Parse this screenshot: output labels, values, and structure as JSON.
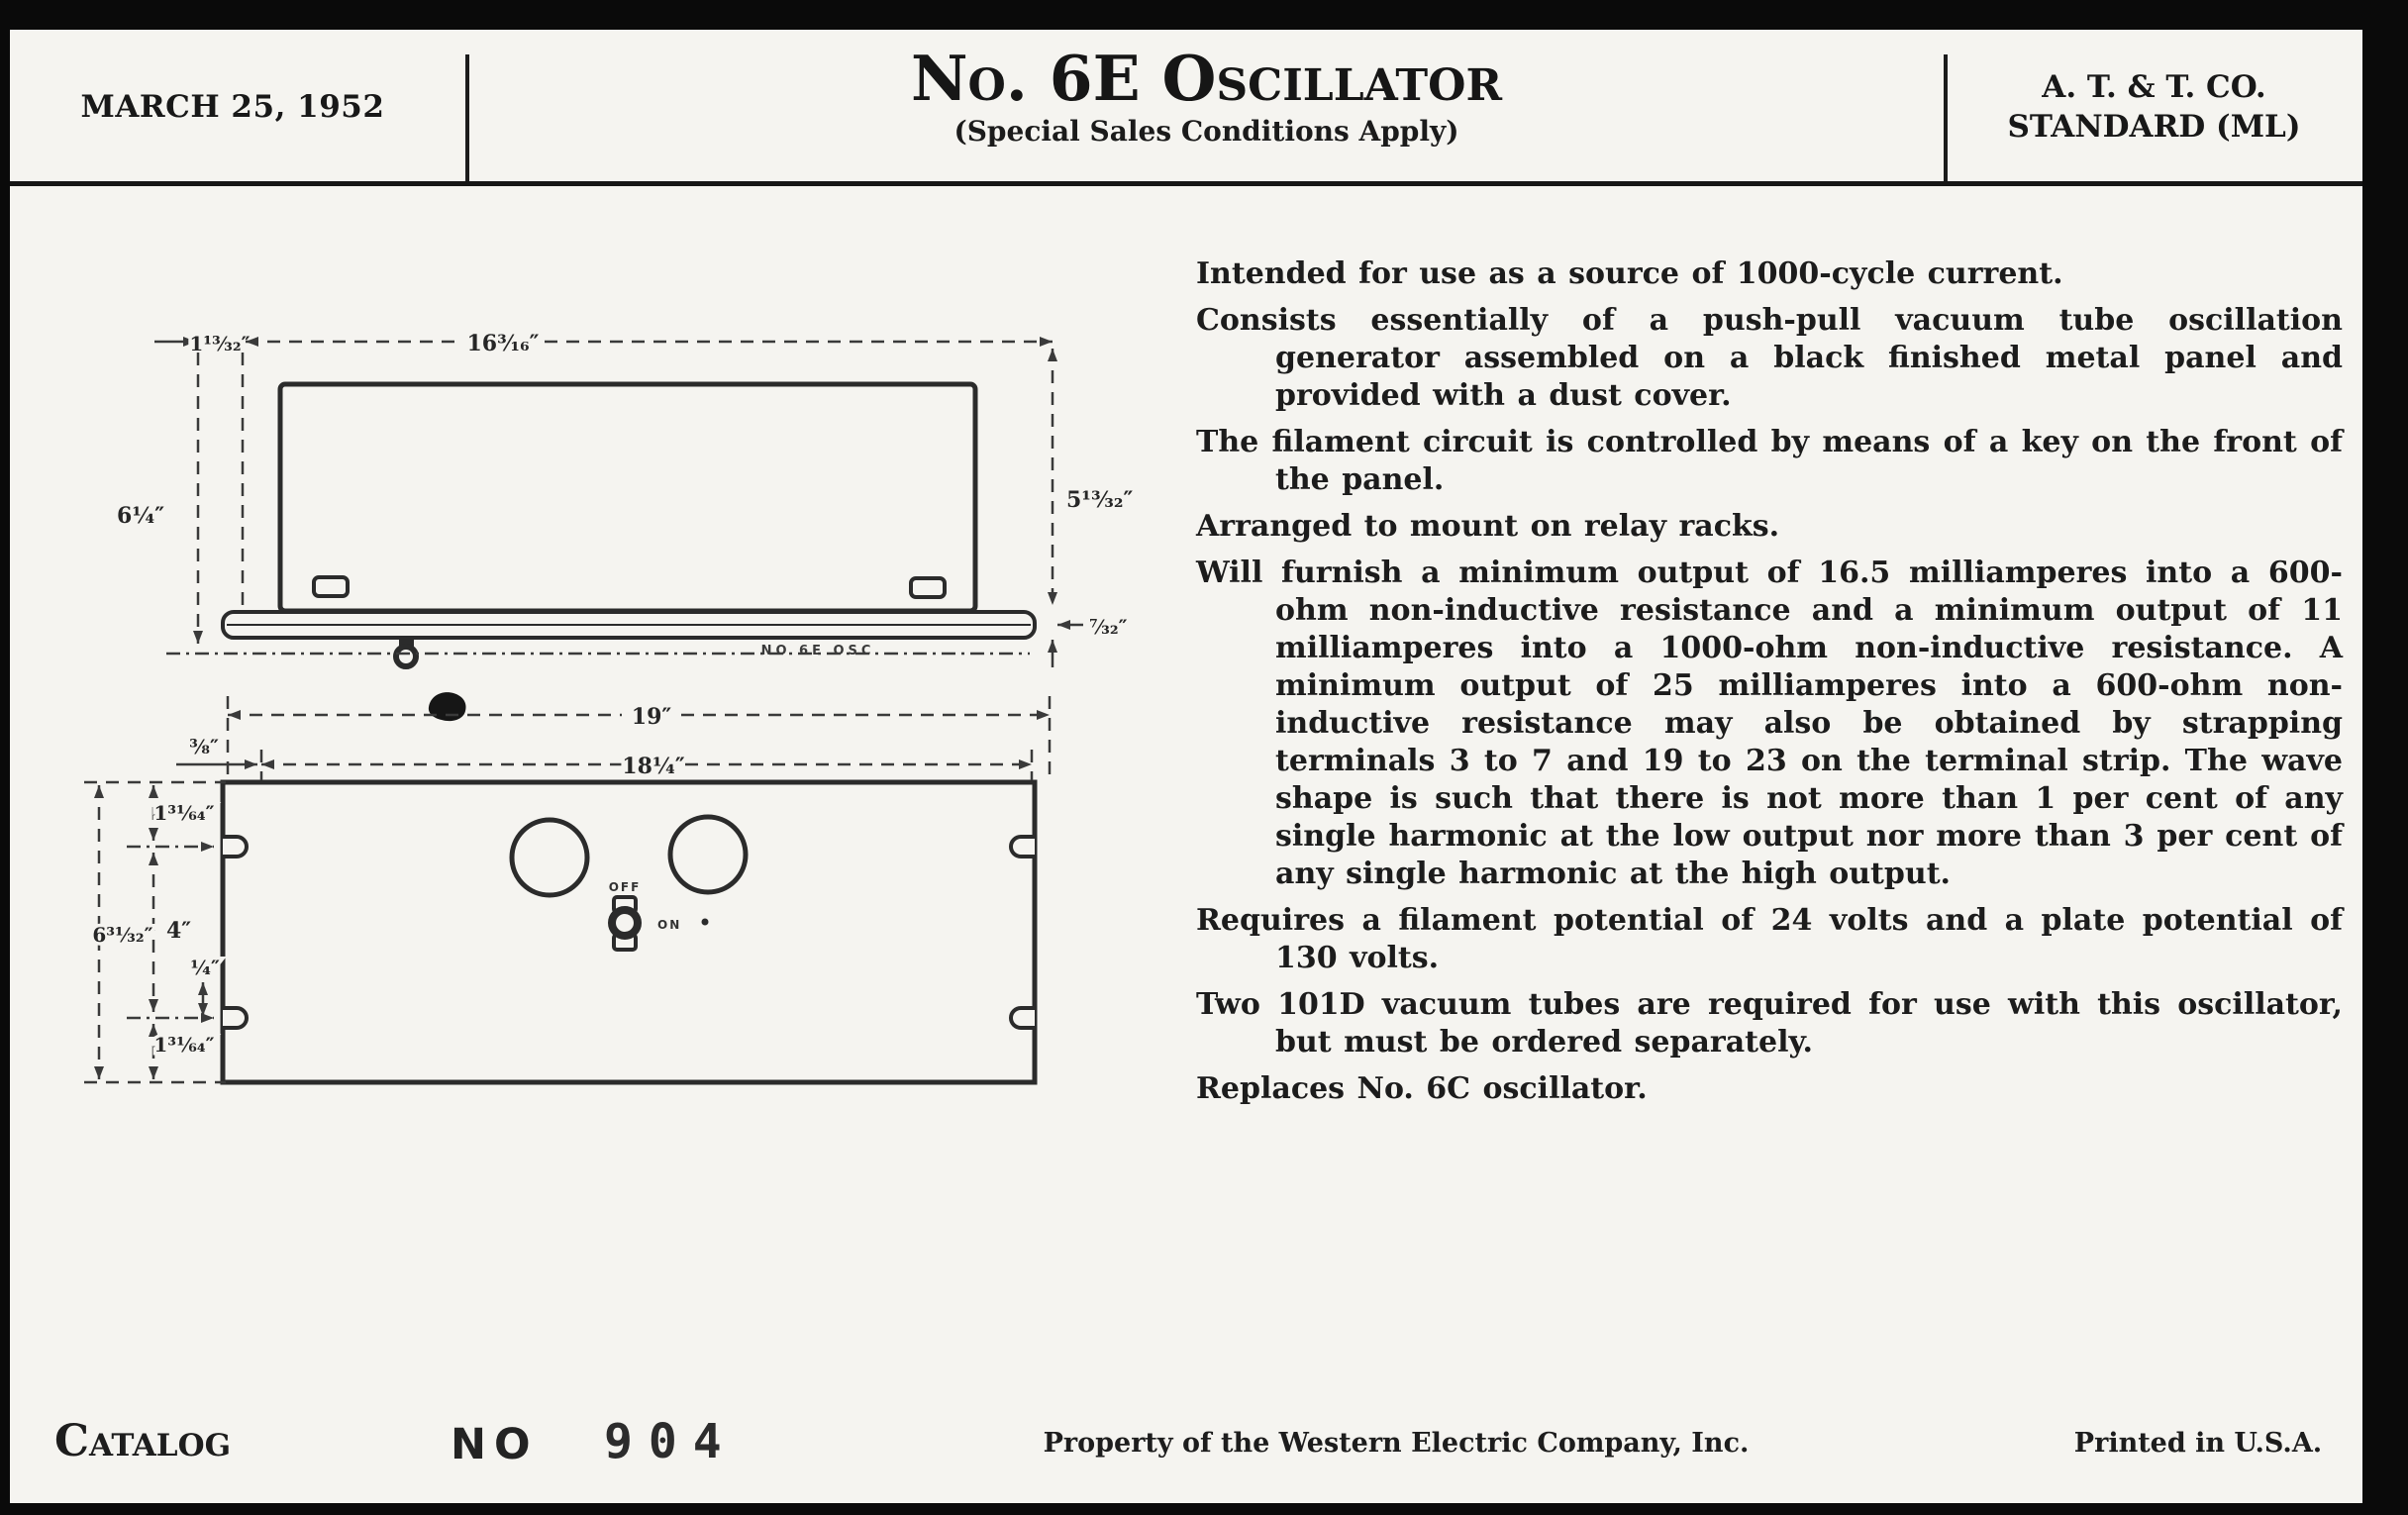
{
  "header": {
    "date": "MARCH 25, 1952",
    "title": "No. 6E Oscillator",
    "subtitle": "(Special Sales Conditions Apply)",
    "org_line1": "A. T. & T. CO.",
    "org_line2": "STANDARD (ML)"
  },
  "description": {
    "paragraphs": [
      "Intended for use as a source of 1000-cycle current.",
      "Consists essentially of a push-pull vacuum tube oscillation generator assembled on a black finished metal panel and provided with a dust cover.",
      "The filament circuit is controlled by means of a key on the front of the panel.",
      "Arranged to mount on relay racks.",
      "Will furnish a minimum output of 16.5 milliamperes into a 600-ohm non-inductive resistance and a minimum output of 11 milliamperes into a 1000-ohm non-inductive resistance.  A minimum output of 25 milliamperes into a 600-ohm non-inductive resistance may also be obtained by strapping terminals 3 to 7 and 19 to 23 on the terminal strip.  The wave shape is such that there is not more than 1 per cent of any single harmonic at the low output nor more than 3 per cent of any single harmonic at the high output.",
      "Requires a filament potential of 24 volts and a plate potential of 130 volts.",
      "Two 101D vacuum tubes are required for use with this oscillator, but must be ordered separately.",
      "Replaces No. 6C oscillator."
    ]
  },
  "drawing": {
    "caption": "NO 6E OSC",
    "switch_off": "OFF",
    "switch_on": "ON",
    "dims": {
      "cover_offset": "1¹³⁄₃₂″",
      "cover_width": "16³⁄₁₆″",
      "cover_height": "6¼″",
      "panel_height_side": "5¹³⁄₃₂″",
      "plate_thickness": "⁷⁄₃₂″",
      "panel_width": "19″",
      "mounting_width": "18¼″",
      "edge_offset": "³⁄₈″",
      "slot_top": "1³¹⁄₆₄″",
      "slot_spacing": "4″",
      "panel_height_front": "6³¹⁄₃₂″",
      "quarter": "¼″",
      "slot_bottom": "1³¹⁄₆₄″"
    }
  },
  "footer": {
    "catalog_label": "Catalog",
    "no_label": "NO",
    "catalog_number": "904",
    "property": "Property of the Western Electric Company, Inc.",
    "printed": "Printed in U.S.A."
  }
}
